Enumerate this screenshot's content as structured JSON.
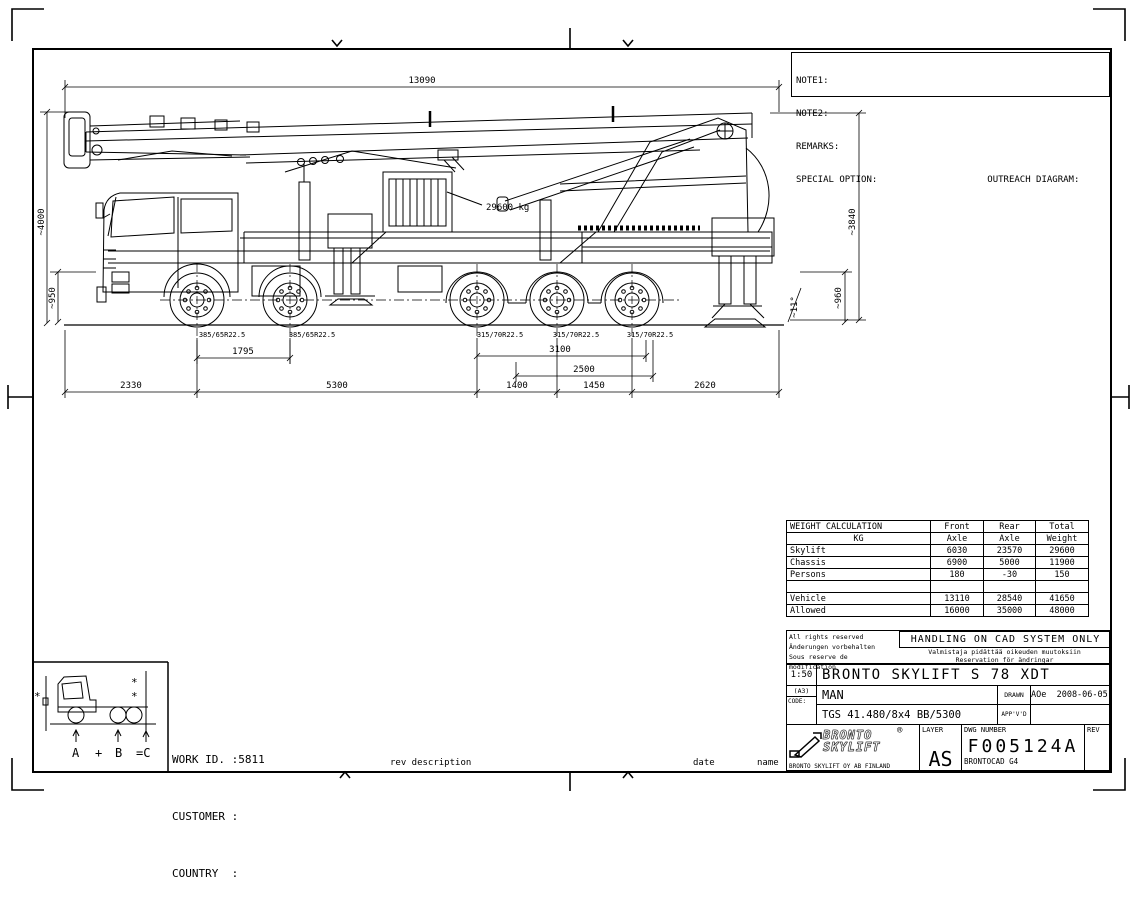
{
  "notes_box": {
    "note1": "NOTE1:",
    "note2": "NOTE2:",
    "remarks": "REMARKS:",
    "special_option": "SPECIAL OPTION:",
    "outreach": "OUTREACH DIAGRAM:"
  },
  "drawing": {
    "payload_label": "29600 kg",
    "dims": {
      "overall_length": "13090",
      "height_left": "~4000",
      "clearance_left": "~950",
      "height_right": "~3840",
      "clearance_right": "~960",
      "jack_angle": "~11°",
      "front_axle_spacing": "1795",
      "rear_axle_spread": "3100",
      "rear_to_jack": "2500",
      "front_overhang": "2330",
      "wheelbase": "5300",
      "rear_spacing_1": "1400",
      "rear_spacing_2": "1450",
      "rear_overhang": "2620"
    },
    "tires": {
      "front": "385/65R22.5",
      "rear": "315/70R22.5"
    }
  },
  "weight_table": {
    "header_top": {
      "label": "WEIGHT CALCULATION",
      "front": "Front",
      "rear": "Rear",
      "total": "Total"
    },
    "header_bottom": {
      "label": "KG",
      "front": "Axle",
      "rear": "Axle",
      "total": "Weight"
    },
    "rows": [
      {
        "label": "Skylift",
        "front": "6030",
        "rear": "23570",
        "total": "29600"
      },
      {
        "label": "Chassis",
        "front": "6900",
        "rear": "5000",
        "total": "11900"
      },
      {
        "label": "Persons",
        "front": "180",
        "rear": "-30",
        "total": "150"
      },
      {
        "label": "",
        "front": "",
        "rear": "",
        "total": ""
      },
      {
        "label": "Vehicle",
        "front": "13110",
        "rear": "28540",
        "total": "41650"
      },
      {
        "label": "Allowed",
        "front": "16000",
        "rear": "35000",
        "total": "48000"
      }
    ]
  },
  "legal": {
    "line1": "All rights reserved",
    "line2": "Änderungen vorbehalten",
    "line3": "Sous reserve de modification",
    "handling": "HANDLING ON CAD SYSTEM ONLY",
    "sub1": "Valmistaja pidättää oikeuden muutoksiin",
    "sub2": "Reservation för ändringar"
  },
  "title_block": {
    "scale": "1:50",
    "sheet": "(A3)",
    "code_label": "CODE:",
    "title": "BRONTO SKYLIFT S 78 XDT",
    "chassis_make": "MAN",
    "drawn_label": "DRAWN",
    "drawn_value": "AOe  2008-06-05",
    "chassis_model": "TGS 41.480/8x4 BB/5300",
    "approved_label": "APP'V'D",
    "layer_label": "LAYER",
    "layer_value": "AS",
    "dwg_number_label": "DWG NUMBER",
    "dwg_number": "F005124A",
    "cad_system": "BRONTOCAD G4",
    "rev_label": "REV",
    "logo_line1": "BRONTO",
    "logo_line2": "SKYLIFT",
    "logo_reg": "®",
    "logo_sub": "BRONTO SKYLIFT OY AB FINLAND"
  },
  "work_info": {
    "work_id_label": "WORK ID. :",
    "work_id_value": "5811",
    "customer_label": "CUSTOMER :",
    "country_label": "COUNTRY  :"
  },
  "rev_strip": {
    "rev_description": "rev description",
    "date": "date",
    "name": "name"
  },
  "axle_box": {
    "left_mark": "*",
    "right_mark_top": "*",
    "right_mark_bottom": "*",
    "a": "A",
    "plus": "+",
    "b": "B",
    "c": "=C"
  }
}
